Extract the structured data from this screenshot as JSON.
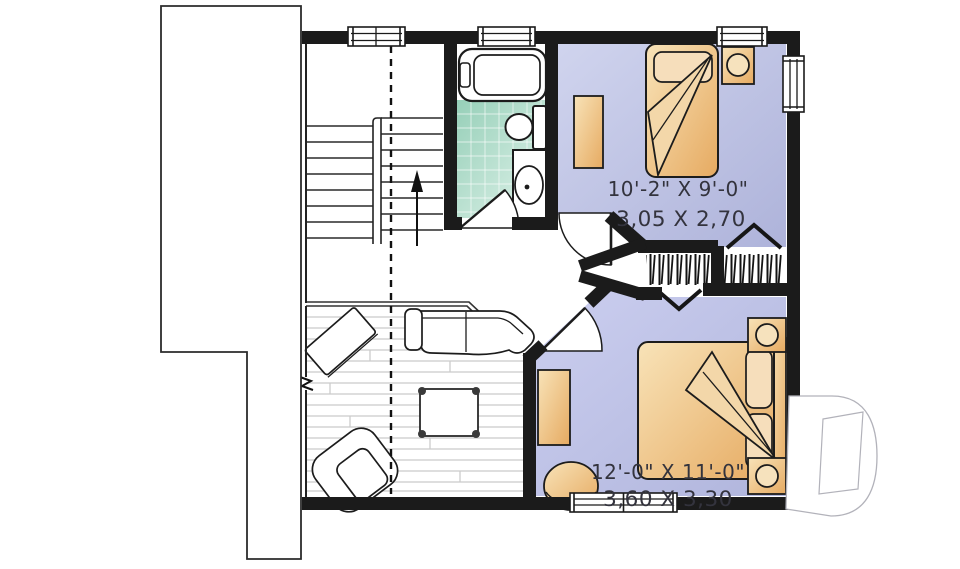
{
  "floor_plan": {
    "bedroom_1": {
      "imperial": "10'-2\" X 9'-0\"",
      "metric": "3,05 X 2,70"
    },
    "bedroom_2": {
      "imperial": "12'-0\" X 11'-0\"",
      "metric": "3,60 X 3,30"
    },
    "icons": {
      "stairs_direction": "up-arrow",
      "watermark": "drummond-d-logo",
      "closet_doors": "bifold-chevron",
      "ceiling_line": "dashed-slope-line"
    },
    "colors": {
      "wall": "#1b1b1b",
      "bedroom_floor": "#c2c6e4",
      "bathroom_tile": "#a9d8c3",
      "furniture_tan": "#eec184",
      "label_text": "#33333d"
    }
  }
}
